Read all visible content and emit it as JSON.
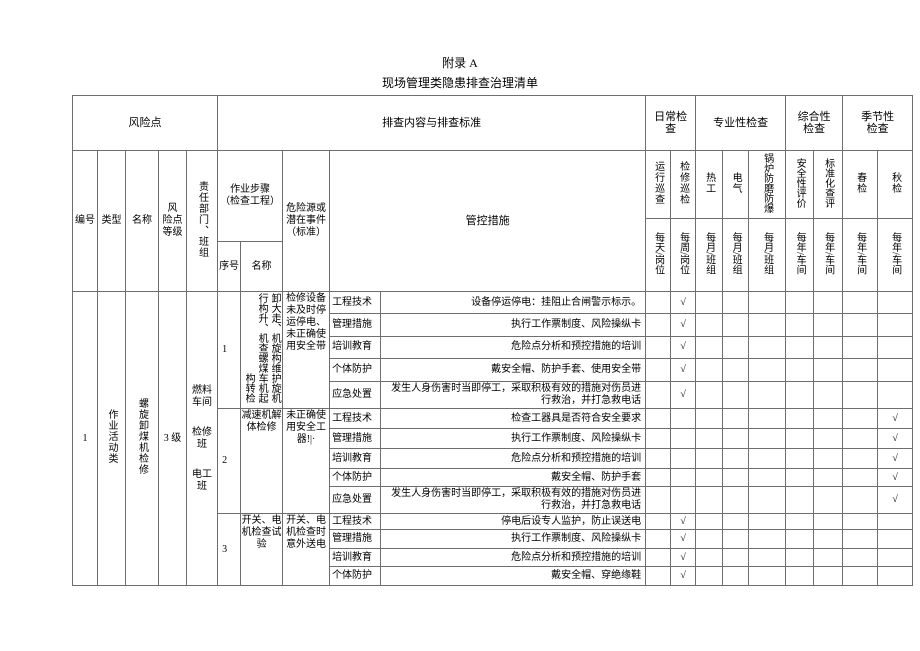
{
  "colors": {
    "text": "#000000",
    "border": "#6e6e6e",
    "background": "#ffffff"
  },
  "page": {
    "title": "附录 A",
    "subtitle": "现场管理类隐患排查治理清单"
  },
  "header": {
    "risk_point": "风险点",
    "inspection_content": "排查内容与排查标准",
    "daily_check": "日常检查",
    "professional_check": "专业性检查",
    "comprehensive_check": "综合性检查",
    "seasonal_check": "季节性检查",
    "col_id": "编号",
    "col_type": "类型",
    "col_name": "名称",
    "col_level": "风\n险点\n等级",
    "col_dept": "责任部门、班组",
    "col_steps": "作业步骤\n（检查工程）",
    "col_step_no": "序号",
    "col_step_name": "名称",
    "col_hazard": "危险源或潜在事件（标准）",
    "col_measures": "管控措施",
    "check_cols": [
      {
        "name": "运行巡查",
        "freq": "每天/岗位"
      },
      {
        "name": "检修巡检",
        "freq": "每周/岗位"
      },
      {
        "name": "热工",
        "freq": "每月/班组"
      },
      {
        "name": "电气",
        "freq": "每月/班组"
      },
      {
        "name": "锅炉防磨防爆",
        "freq": "每月/班组"
      },
      {
        "name": "安全性评价",
        "freq": "每年/车间"
      },
      {
        "name": "标准化查评",
        "freq": "每年/车间"
      },
      {
        "name": "春检",
        "freq": "每年/车间"
      },
      {
        "name": "秋检",
        "freq": "每年/车间"
      }
    ]
  },
  "row": {
    "id": "1",
    "type": "作业活动类",
    "name": "螺旋卸煤机检修",
    "level": "3 级",
    "dept_groups": [
      "燃料车间",
      "检修班",
      "电工班"
    ],
    "steps": [
      {
        "no": "1",
        "name_lines": [
          "卸大走、机旋构维护旋机",
          "行构升、机查螺煤车机起",
          "构转检"
        ],
        "hazard": "检修设备未及时停运停电、未正确使用安全带",
        "measures": [
          {
            "category": "工程技术",
            "text": "设备停运停电：挂阻止合闸警示标示。",
            "check_marks": [
              "",
              "√",
              "",
              "",
              "",
              "",
              "",
              "",
              ""
            ]
          },
          {
            "category": "管理措施",
            "text": "执行工作票制度、风险操纵卡",
            "check_marks": [
              "",
              "√",
              "",
              "",
              "",
              "",
              "",
              "",
              ""
            ]
          },
          {
            "category": "培训教育",
            "text": "危险点分析和预控措施的培训",
            "check_marks": [
              "",
              "√",
              "",
              "",
              "",
              "",
              "",
              "",
              ""
            ]
          },
          {
            "category": "个体防护",
            "text": "戴安全帽、防护手套、使用安全带",
            "check_marks": [
              "",
              "√",
              "",
              "",
              "",
              "",
              "",
              "",
              ""
            ]
          },
          {
            "category": "应急处置",
            "text": "发生人身伤害时当即停工，采取积极有效的措施对伤员进行救治，并打急救电话",
            "check_marks": [
              "",
              "√",
              "",
              "",
              "",
              "",
              "",
              "",
              ""
            ]
          }
        ]
      },
      {
        "no": "2",
        "name": "减速机解体检修",
        "hazard": "未正确使用安全工器!|·",
        "measures": [
          {
            "category": "工程技术",
            "text": "检查工器具是否符合安全要求",
            "check_marks": [
              "",
              "",
              "",
              "",
              "",
              "",
              "",
              "",
              "√"
            ]
          },
          {
            "category": "管理措施",
            "text": "执行工作票制度、风险操纵卡",
            "check_marks": [
              "",
              "",
              "",
              "",
              "",
              "",
              "",
              "",
              "√"
            ]
          },
          {
            "category": "培训教育",
            "text": "危险点分析和预控措施的培训",
            "check_marks": [
              "",
              "",
              "",
              "",
              "",
              "",
              "",
              "",
              "√"
            ]
          },
          {
            "category": "个体防护",
            "text": "戴安全帽、防护手套",
            "check_marks": [
              "",
              "",
              "",
              "",
              "",
              "",
              "",
              "",
              "√"
            ]
          },
          {
            "category": "应急处置",
            "text": "发生人身伤害时当即停工，采取积极有效的措施对伤员进行救治，并打急救电话",
            "check_marks": [
              "",
              "",
              "",
              "",
              "",
              "",
              "",
              "",
              "√"
            ]
          }
        ]
      },
      {
        "no": "3",
        "name": "开关、电机检查试验",
        "hazard": "开关、电机检查时意外送电",
        "measures": [
          {
            "category": "工程技术",
            "text": "停电后设专人监护，防止误送电",
            "check_marks": [
              "",
              "√",
              "",
              "",
              "",
              "",
              "",
              "",
              ""
            ]
          },
          {
            "category": "管理措施",
            "text": "执行工作票制度、风险操纵卡",
            "check_marks": [
              "",
              "√",
              "",
              "",
              "",
              "",
              "",
              "",
              ""
            ]
          },
          {
            "category": "培训教育",
            "text": "危险点分析和预控措施的培训",
            "check_marks": [
              "",
              "√",
              "",
              "",
              "",
              "",
              "",
              "",
              ""
            ]
          },
          {
            "category": "个体防护",
            "text": "戴安全帽、穿绝缘鞋",
            "check_marks": [
              "",
              "√",
              "",
              "",
              "",
              "",
              "",
              "",
              ""
            ]
          }
        ]
      }
    ]
  }
}
